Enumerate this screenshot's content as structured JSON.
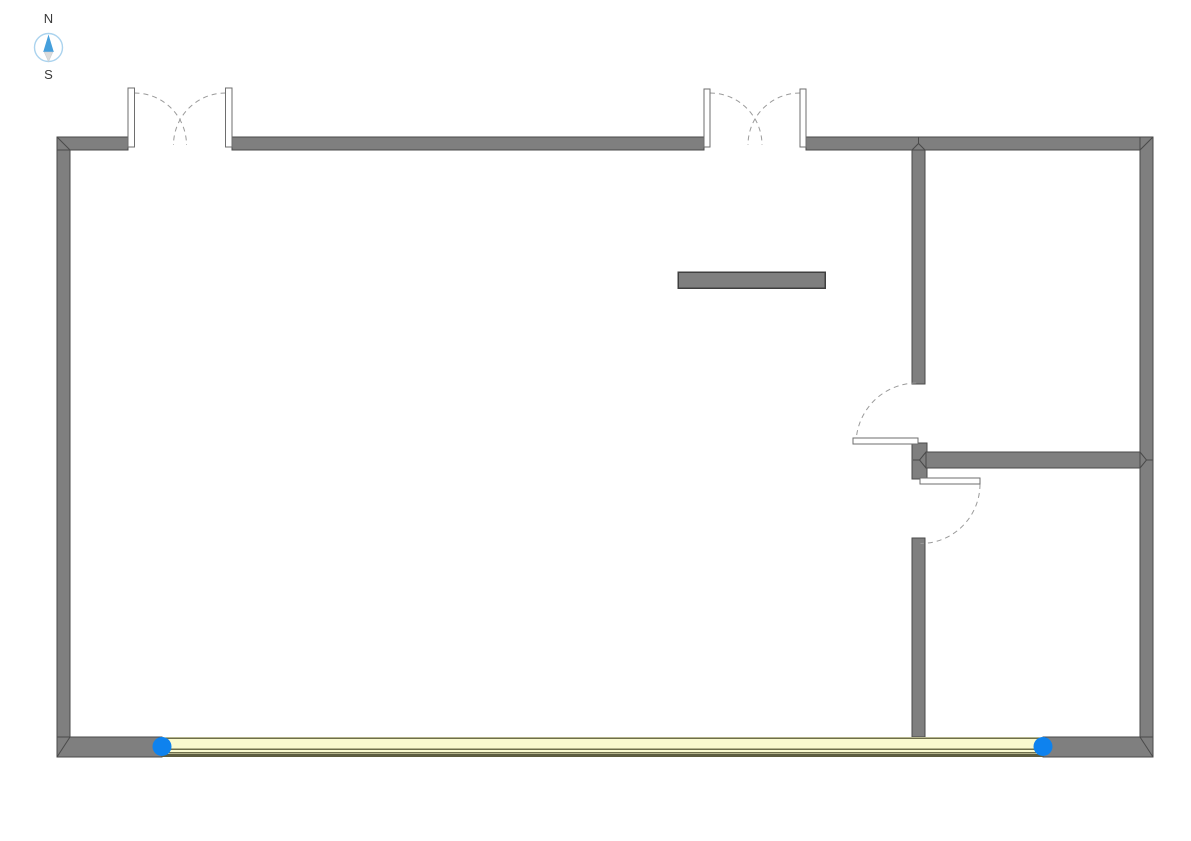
{
  "canvas": {
    "width": 1191,
    "height": 841,
    "background": "#ffffff"
  },
  "colors": {
    "wall_fill": "#7f7f7f",
    "wall_edge": "#4a4a4a",
    "island_edge": "#3f3f3f",
    "door_panel_fill": "#ffffff",
    "door_panel_edge": "#6e6e6e",
    "swing_arc": "#9a9a9a",
    "glazing_fill": "#f9f9ce",
    "mullion": "#6e6e4a",
    "glazing_edge": "#5d5d40",
    "grip_dot": "#0e82ee",
    "compass_ring": "#abd3ee",
    "compass_needle_north": "#459fdc",
    "compass_needle_south": "#dcdcdc",
    "compass_label": "#3a3a3a"
  },
  "compass": {
    "north_label": "N",
    "south_label": "S"
  },
  "plan": {
    "walls": {
      "exterior": [
        "west",
        "north-west-segment",
        "north-middle-segment",
        "north-east-segment",
        "east",
        "south-west-stub",
        "south-east-stub"
      ],
      "interior": [
        "vertical-partition-upper",
        "partition-junction-block",
        "vertical-partition-lower",
        "horizontal-partition"
      ]
    },
    "doors": [
      {
        "name": "double-door-west",
        "leaves": 2,
        "swing": "outward-north"
      },
      {
        "name": "double-door-middle",
        "leaves": 2,
        "swing": "outward-north"
      },
      {
        "name": "single-door-upper",
        "leaves": 1,
        "swing": "into-main-room"
      },
      {
        "name": "single-door-lower",
        "leaves": 1,
        "swing": "into-southeast-room"
      }
    ],
    "curtain_wall": {
      "location": "south",
      "grips": 2
    },
    "furniture": [
      {
        "name": "freestanding-wall-segment",
        "shape": "rectangle"
      }
    ]
  }
}
